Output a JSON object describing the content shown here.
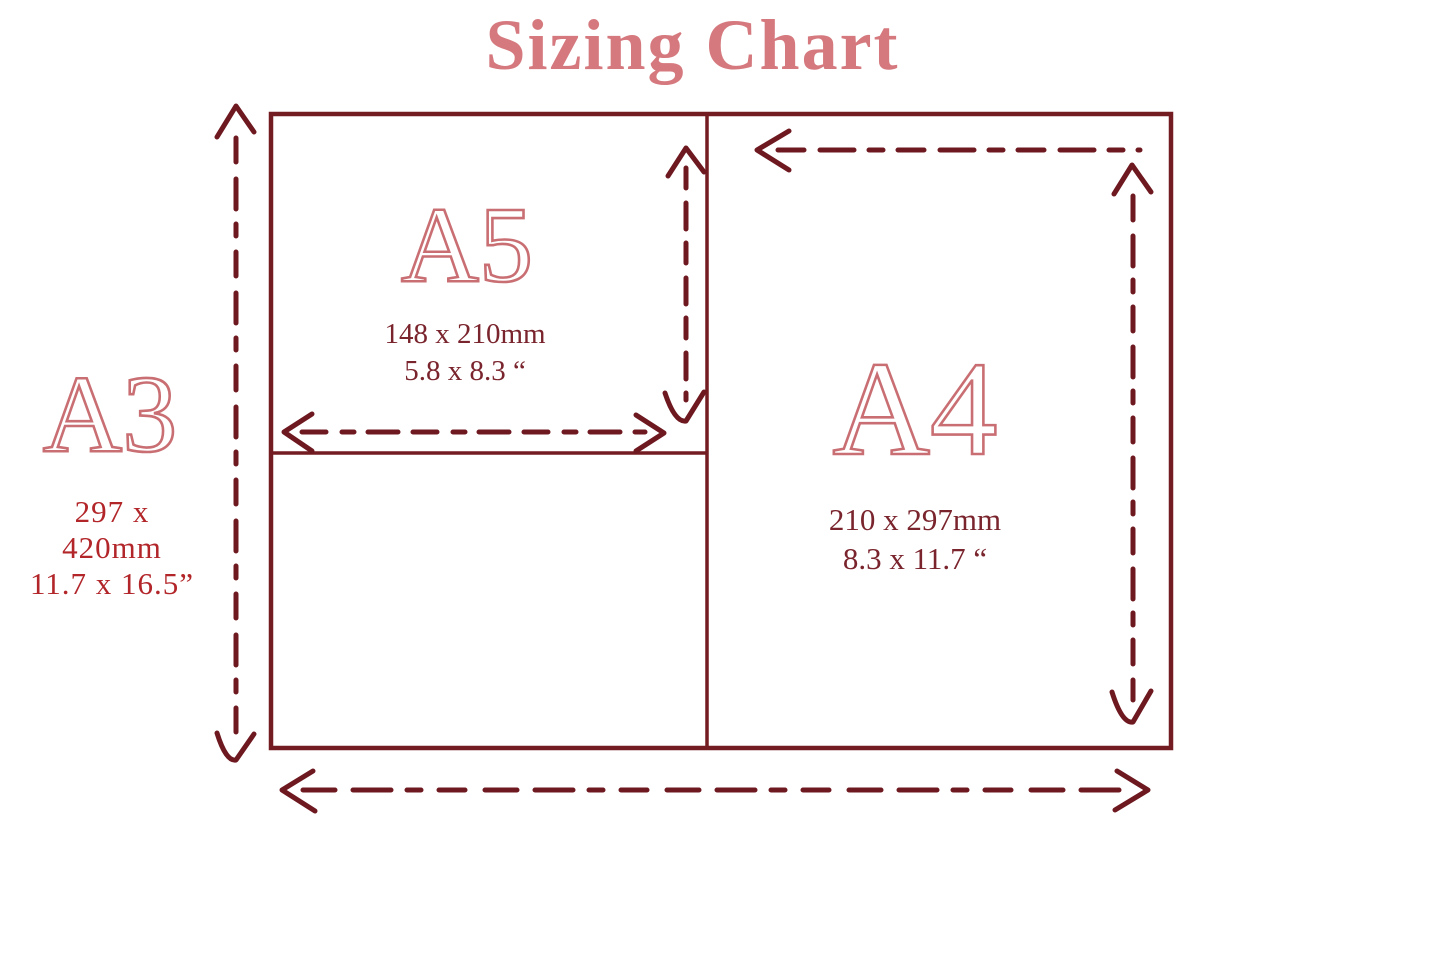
{
  "title": "Sizing Chart",
  "colors": {
    "title_pink": "#d5797e",
    "label_outline_pink": "#c96f73",
    "line_maroon": "#731c21",
    "arrow_maroon": "#6e1820",
    "dims_text_maroon": "#7a242d",
    "a3_dims_red": "#b2262a"
  },
  "papers": {
    "a5": {
      "label": "A5",
      "dims_mm": "148 x 210mm",
      "dims_inches": "5.8 x 8.3 “"
    },
    "a4": {
      "label": "A4",
      "dims_mm": "210 x 297mm",
      "dims_inches": "8.3 x 11.7 “"
    },
    "a3": {
      "label": "A3",
      "dims_line1": "297 x",
      "dims_line2": "420mm",
      "dims_line3": "11.7 x 16.5”"
    }
  }
}
